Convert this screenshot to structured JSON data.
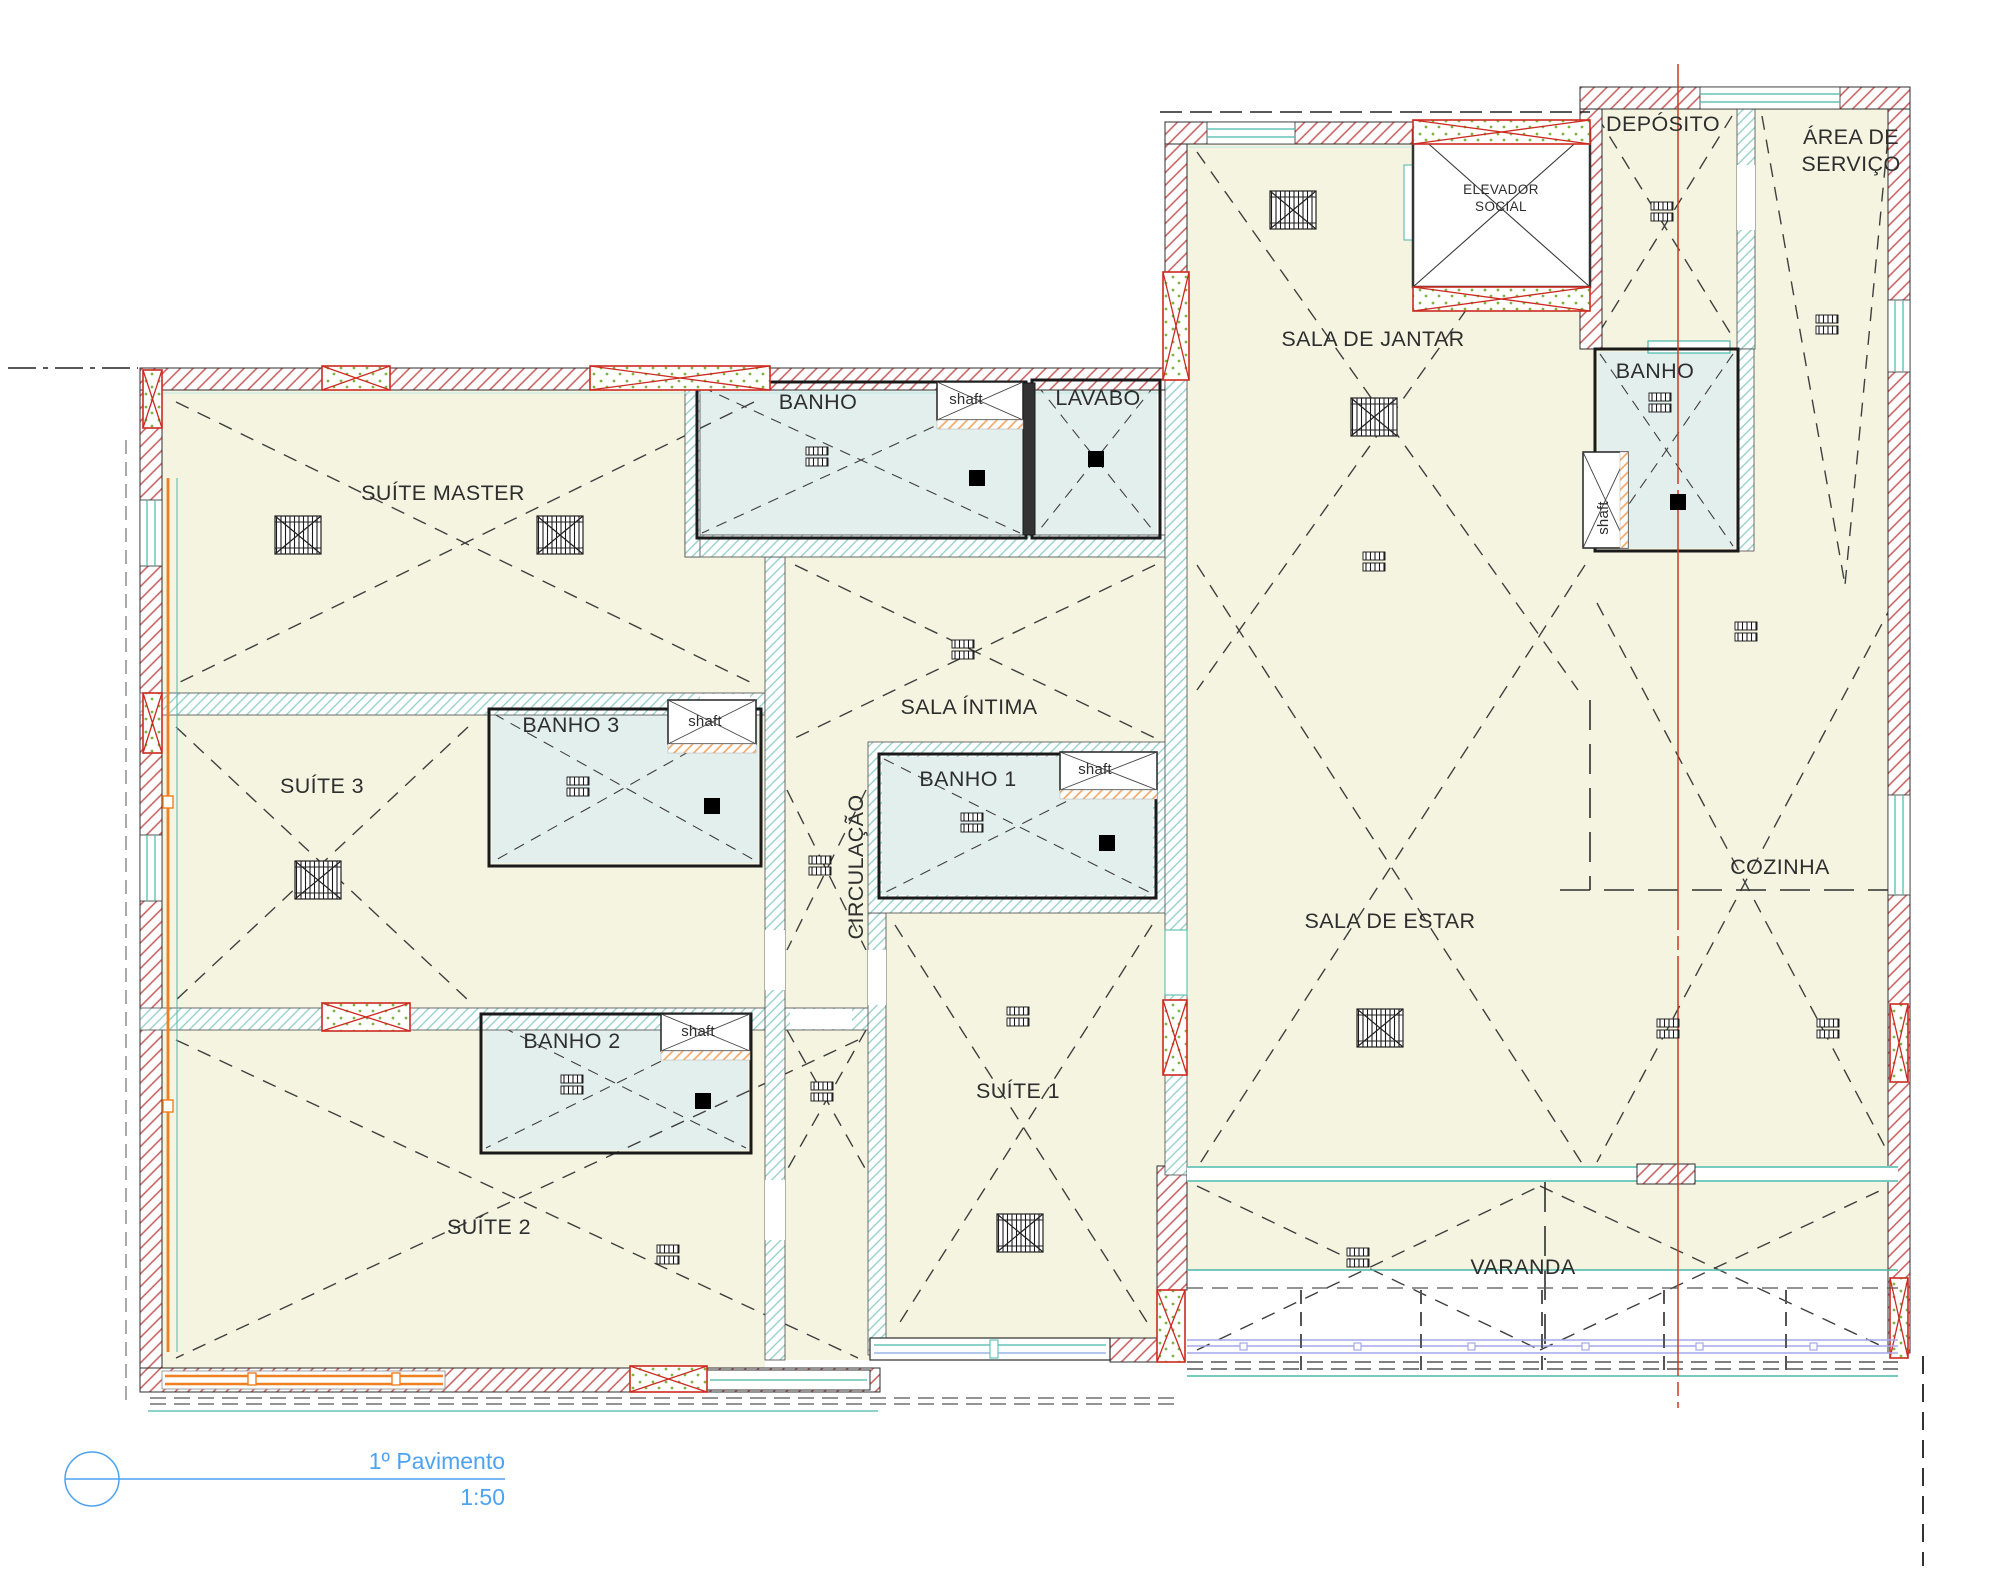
{
  "drawing": {
    "footer": {
      "title": "1º Pavimento",
      "scale": "1:50"
    },
    "labels": {
      "suite_master": "SUÍTE MASTER",
      "suite_3": "SUÍTE 3",
      "suite_2": "SUÍTE 2",
      "suite_1": "SUÍTE 1",
      "banho": "BANHO",
      "banho_1": "BANHO 1",
      "banho_2": "BANHO 2",
      "banho_3": "BANHO 3",
      "banho_servico": "BANHO",
      "lavabo": "LAVABO",
      "sala_intima": "SALA ÍNTIMA",
      "circulacao": "CIRCULAÇÃO",
      "sala_de_jantar": "SALA DE JANTAR",
      "sala_de_estar": "SALA DE ESTAR",
      "cozinha": "COZINHA",
      "varanda": "VARANDA",
      "deposito": "DEPÓSITO",
      "area_de_servico_line1": "ÁREA DE",
      "area_de_servico_line2": "SERVIÇO",
      "elevador_line1": "ELEVADOR",
      "elevador_line2": "SOCIAL",
      "shaft": "shaft"
    },
    "colors": {
      "floor_cream": "#f5f4e1",
      "bath_blue": "#e3efec",
      "exterior_wall_hatch_red": "#c65b5b",
      "interior_wall_hatch_teal": "#8fcfc4",
      "shaft_hatch_orange": "#f2a45f",
      "lintel_red": "#cc2a20",
      "lintel_dot_green": "#7cb342",
      "window_teal": "#49b8a8",
      "window_orange": "#f07f1f",
      "guardrail_purple": "#a3a8ea",
      "centerline_red": "#cc3a28",
      "annotation_blue": "#4da3f2",
      "line_dark": "#2d2d2d"
    }
  }
}
